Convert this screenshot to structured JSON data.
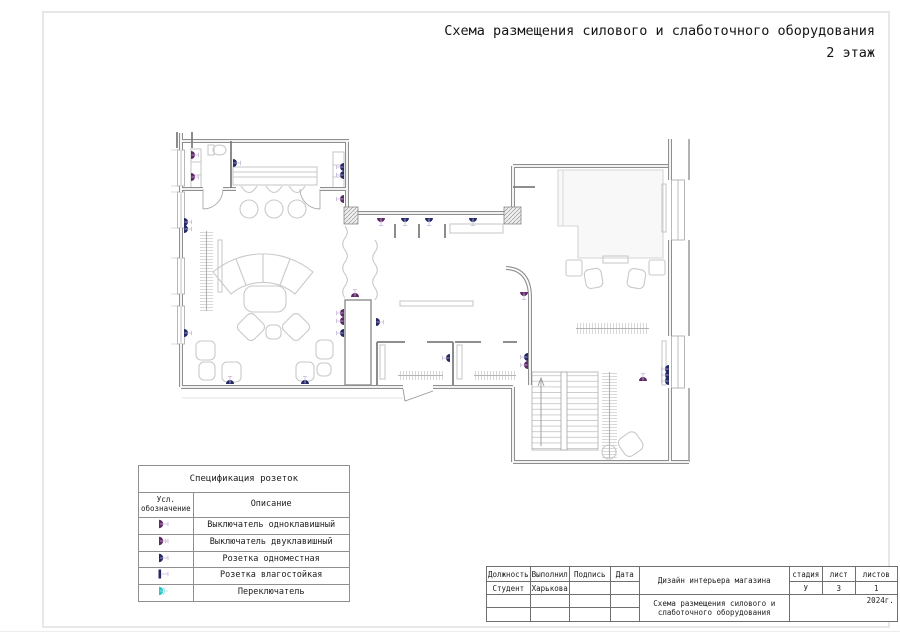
{
  "page": {
    "title_line1": "Схема размещения силового и слаботочного оборудования",
    "title_line2": "2 этаж"
  },
  "colors": {
    "switch": "#5e2a66",
    "socket": "#242a66",
    "toggle": "#2fc4c9",
    "toggle_light": "#a9e8e9",
    "tick": "#c8b7da",
    "wall": "#8f8f8f",
    "furniture": "#c9c9c9",
    "text": "#1c1c1c"
  },
  "legend": {
    "title": "Спецификация розеток",
    "col1_header_line1": "Усл.",
    "col1_header_line2": "обозначение",
    "col2_header": "Описание",
    "rows": [
      {
        "symbol": "switch-1",
        "label": "Выключатель одноклавишный"
      },
      {
        "symbol": "switch-2",
        "label": "Выключатель двуклавишный"
      },
      {
        "symbol": "socket",
        "label": "Розетка одноместная"
      },
      {
        "symbol": "socket-wp",
        "label": "Розетка влагостойкая"
      },
      {
        "symbol": "toggle",
        "label": "Переключатель"
      }
    ]
  },
  "title_block": {
    "h_position": "Должность",
    "h_executed": "Выполнил",
    "h_signature": "Подпись",
    "h_date": "Дата",
    "position": "Студент",
    "executed": "Харькова",
    "project": "Дизайн интерьера магазина",
    "drawing_title_line1": "Схема размещения силового и",
    "drawing_title_line2": "слаботочного оборудования",
    "h_stage": "стадия",
    "h_sheet": "лист",
    "h_sheets": "листов",
    "stage": "У",
    "sheet": "3",
    "sheets": "1",
    "year": "2024г."
  },
  "floor_plan": {
    "symbols": [
      {
        "x": 191,
        "y": 155,
        "rot": 0,
        "type": "switch-1"
      },
      {
        "x": 191,
        "y": 177,
        "rot": 0,
        "type": "switch-2"
      },
      {
        "x": 233,
        "y": 163,
        "rot": 0,
        "type": "socket"
      },
      {
        "x": 344,
        "y": 167,
        "rot": 180,
        "type": "socket"
      },
      {
        "x": 344,
        "y": 175,
        "rot": 180,
        "type": "socket"
      },
      {
        "x": 344,
        "y": 199,
        "rot": 180,
        "type": "switch-1"
      },
      {
        "x": 184,
        "y": 222,
        "rot": 0,
        "type": "socket"
      },
      {
        "x": 184,
        "y": 229,
        "rot": 0,
        "type": "socket"
      },
      {
        "x": 184,
        "y": 333,
        "rot": 0,
        "type": "socket"
      },
      {
        "x": 230,
        "y": 384,
        "rot": 270,
        "type": "socket"
      },
      {
        "x": 305,
        "y": 384,
        "rot": 270,
        "type": "socket"
      },
      {
        "x": 355,
        "y": 297,
        "rot": 270,
        "type": "switch-1"
      },
      {
        "x": 344,
        "y": 313,
        "rot": 180,
        "type": "switch-1"
      },
      {
        "x": 344,
        "y": 321,
        "rot": 180,
        "type": "switch-2"
      },
      {
        "x": 344,
        "y": 333,
        "rot": 180,
        "type": "socket"
      },
      {
        "x": 376,
        "y": 322,
        "rot": 0,
        "type": "socket"
      },
      {
        "x": 381,
        "y": 218,
        "rot": 90,
        "type": "switch-1"
      },
      {
        "x": 405,
        "y": 218,
        "rot": 90,
        "type": "socket"
      },
      {
        "x": 429,
        "y": 218,
        "rot": 90,
        "type": "socket"
      },
      {
        "x": 473,
        "y": 218,
        "rot": 90,
        "type": "socket"
      },
      {
        "x": 524,
        "y": 292,
        "rot": 90,
        "type": "switch-1"
      },
      {
        "x": 450,
        "y": 358,
        "rot": 180,
        "type": "socket"
      },
      {
        "x": 528,
        "y": 357,
        "rot": 180,
        "type": "socket"
      },
      {
        "x": 528,
        "y": 365,
        "rot": 180,
        "type": "switch-1"
      },
      {
        "x": 643,
        "y": 381,
        "rot": 270,
        "type": "switch-1"
      },
      {
        "x": 669,
        "y": 369,
        "rot": 180,
        "type": "socket"
      },
      {
        "x": 669,
        "y": 375,
        "rot": 180,
        "type": "socket"
      },
      {
        "x": 669,
        "y": 381,
        "rot": 180,
        "type": "socket"
      }
    ]
  }
}
